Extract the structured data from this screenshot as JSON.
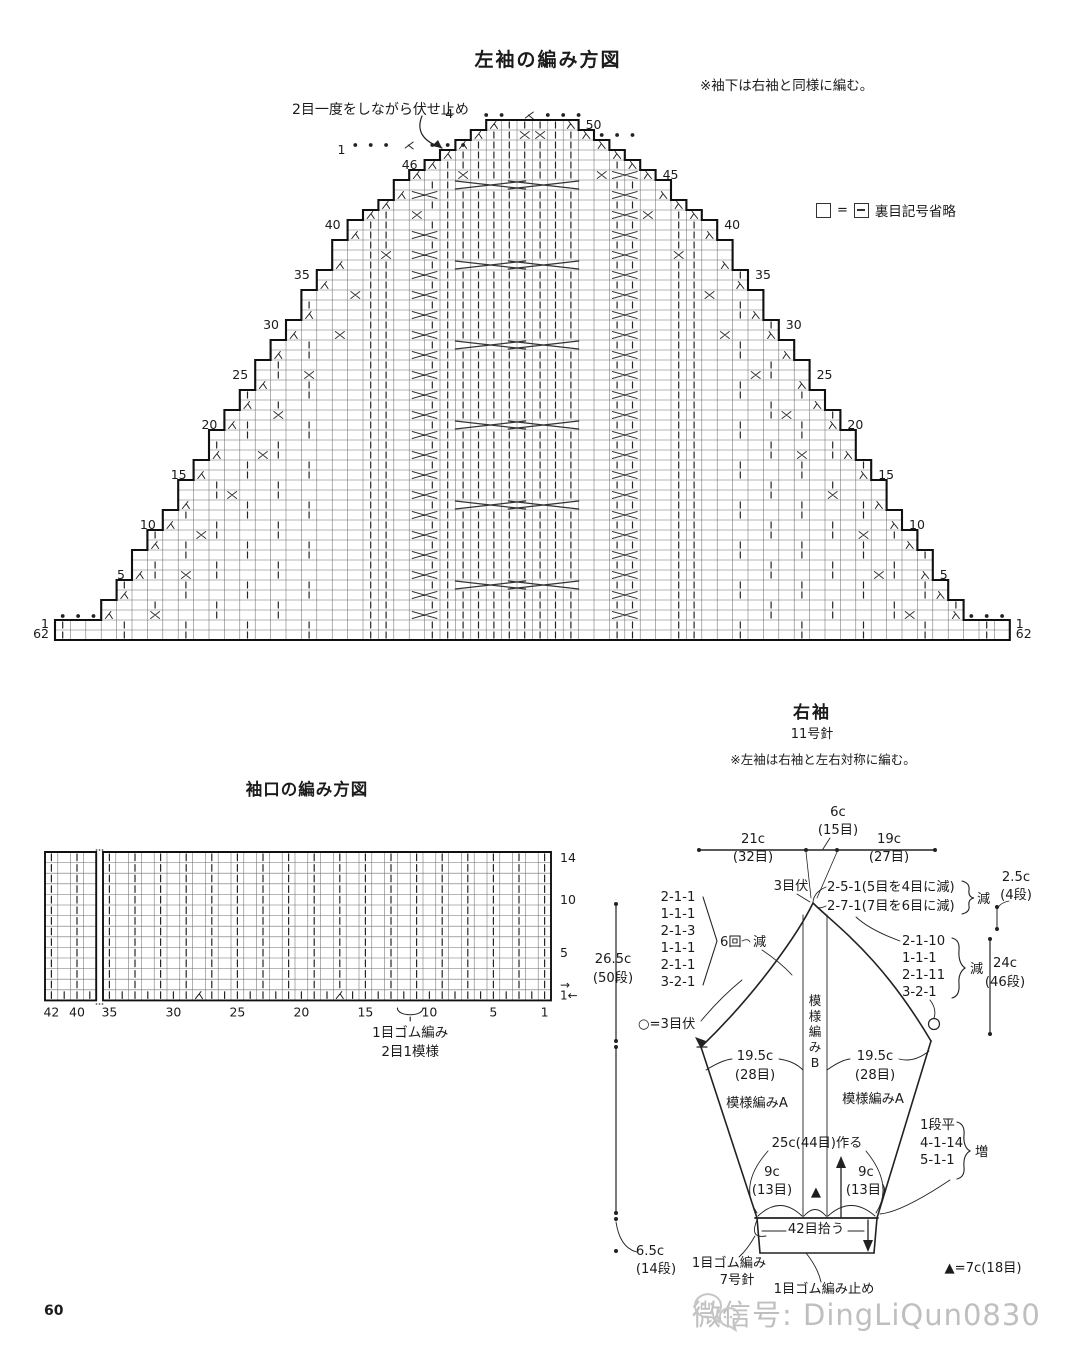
{
  "page": {
    "number": "60",
    "watermark_text": "微信号: DingLiQun0830"
  },
  "main_chart": {
    "title": "左袖の編み方図",
    "note": "※袖下は右袖と同様に編む。",
    "bind_off_annotation": "2目一度をしながら伏せ止め",
    "legend_equals": "=",
    "legend_text": "裏目記号省略",
    "top_stitch_labels": {
      "four": "4",
      "left_one": "1"
    },
    "left_row_labels": [
      46,
      40,
      35,
      30,
      25,
      20,
      15,
      10,
      5
    ],
    "right_row_labels": [
      50,
      45,
      40,
      35,
      30,
      25,
      20,
      15,
      10,
      5
    ],
    "bottom_row_labels": [
      "1",
      "62"
    ],
    "cols": 62,
    "cap_rows": 50,
    "base_rows": 2
  },
  "cuff_chart": {
    "title": "袖口の編み方図",
    "bottom_labels": [
      "42",
      "40",
      "35",
      "30",
      "25",
      "20",
      "15",
      "10",
      "5",
      "1"
    ],
    "right_labels": [
      "14",
      "10",
      "5"
    ],
    "direction_arrows": [
      "→",
      "1←"
    ],
    "repeat_brace_labels": [
      "1目ゴム編み",
      "2目1模様"
    ],
    "rows": 14
  },
  "schematic": {
    "title": "右袖",
    "needle": "11号針",
    "note": "※左袖は右袖と左右対称に編む。",
    "labels": [
      {
        "id": "width-21c",
        "t": "21c",
        "x": 753,
        "y": 843
      },
      {
        "id": "width-21c-sts",
        "t": "(32目)",
        "x": 753,
        "y": 861
      },
      {
        "id": "width-6c",
        "t": "6c",
        "x": 838,
        "y": 816
      },
      {
        "id": "width-6c-sts",
        "t": "(15目)",
        "x": 838,
        "y": 834
      },
      {
        "id": "width-19c",
        "t": "19c",
        "x": 889,
        "y": 843
      },
      {
        "id": "width-19c-sts",
        "t": "(27目)",
        "x": 889,
        "y": 861
      },
      {
        "id": "bind-off-3",
        "t": "3目伏",
        "x": 791,
        "y": 890
      },
      {
        "id": "dec-right-a1",
        "t": "2-5-1(5目を4目に減)",
        "x": 827,
        "y": 891,
        "a": "start"
      },
      {
        "id": "dec-right-a2",
        "t": "2-7-1(7目を6目に減)",
        "x": 827,
        "y": 910,
        "a": "start"
      },
      {
        "id": "dec-right-a-label",
        "t": "減",
        "x": 977,
        "y": 903,
        "a": "start"
      },
      {
        "id": "height-2-5c",
        "t": "2.5c",
        "x": 1016,
        "y": 881
      },
      {
        "id": "height-2-5c-rows",
        "t": "(4段)",
        "x": 1016,
        "y": 899
      },
      {
        "id": "dec-left-1",
        "t": "2-1-1",
        "x": 678,
        "y": 901
      },
      {
        "id": "dec-left-2",
        "t": "1-1-1",
        "x": 678,
        "y": 918
      },
      {
        "id": "dec-left-3",
        "t": "2-1-3",
        "x": 678,
        "y": 935
      },
      {
        "id": "dec-left-4",
        "t": "1-1-1",
        "x": 678,
        "y": 952
      },
      {
        "id": "dec-left-5",
        "t": "2-1-1",
        "x": 678,
        "y": 969
      },
      {
        "id": "dec-left-6",
        "t": "3-2-1",
        "x": 678,
        "y": 986
      },
      {
        "id": "dec-left-times",
        "t": "6回",
        "x": 720,
        "y": 946,
        "a": "start"
      },
      {
        "id": "dec-left-label",
        "t": "減",
        "x": 753,
        "y": 946,
        "a": "start"
      },
      {
        "id": "height-26-5c",
        "t": "26.5c",
        "x": 613,
        "y": 963
      },
      {
        "id": "height-26-5c-rows",
        "t": "(50段)",
        "x": 613,
        "y": 982
      },
      {
        "id": "dec-right-b1",
        "t": "2-1-10",
        "x": 902,
        "y": 945,
        "a": "start"
      },
      {
        "id": "dec-right-b2",
        "t": "1-1-1",
        "x": 902,
        "y": 962,
        "a": "start"
      },
      {
        "id": "dec-right-b3",
        "t": "2-1-11",
        "x": 902,
        "y": 979,
        "a": "start"
      },
      {
        "id": "dec-right-b4",
        "t": "3-2-1",
        "x": 902,
        "y": 996,
        "a": "start"
      },
      {
        "id": "dec-right-b-label",
        "t": "減",
        "x": 970,
        "y": 973,
        "a": "start"
      },
      {
        "id": "height-24c",
        "t": "24c",
        "x": 1005,
        "y": 967
      },
      {
        "id": "height-24c-rows",
        "t": "(46段)",
        "x": 1005,
        "y": 986
      },
      {
        "id": "circle-legend",
        "t": "○=3目伏",
        "x": 638,
        "y": 1028,
        "a": "start"
      },
      {
        "id": "width-19-5c-left",
        "t": "19.5c",
        "x": 755,
        "y": 1060
      },
      {
        "id": "width-19-5c-left-sts",
        "t": "(28目)",
        "x": 755,
        "y": 1079
      },
      {
        "id": "width-19-5c-right",
        "t": "19.5c",
        "x": 875,
        "y": 1060
      },
      {
        "id": "width-19-5c-right-sts",
        "t": "(28目)",
        "x": 875,
        "y": 1079
      },
      {
        "id": "panel-b",
        "t": "模様編みB",
        "x": 815,
        "y": 1005,
        "v": true
      },
      {
        "id": "panel-a-left",
        "t": "模様編みA",
        "x": 757,
        "y": 1107
      },
      {
        "id": "panel-a-right",
        "t": "模様編みA",
        "x": 873,
        "y": 1103
      },
      {
        "id": "cast-on",
        "t": "25c(44目)作る",
        "x": 817,
        "y": 1147
      },
      {
        "id": "inc-flat",
        "t": "1段平",
        "x": 920,
        "y": 1129,
        "a": "start"
      },
      {
        "id": "inc-seq1",
        "t": "4-1-14",
        "x": 920,
        "y": 1147,
        "a": "start"
      },
      {
        "id": "inc-seq2",
        "t": "5-1-1",
        "x": 920,
        "y": 1164,
        "a": "start"
      },
      {
        "id": "inc-label",
        "t": "増",
        "x": 975,
        "y": 1156,
        "a": "start"
      },
      {
        "id": "width-9c-left",
        "t": "9c",
        "x": 772,
        "y": 1176
      },
      {
        "id": "width-9c-left-sts",
        "t": "(13目)",
        "x": 772,
        "y": 1194
      },
      {
        "id": "width-9c-right",
        "t": "9c",
        "x": 866,
        "y": 1176
      },
      {
        "id": "width-9c-right-sts",
        "t": "(13目)",
        "x": 866,
        "y": 1194
      },
      {
        "id": "pickup-42",
        "t": "42目拾う",
        "x": 816,
        "y": 1233
      },
      {
        "id": "height-6-5c",
        "t": "6.5c",
        "x": 650,
        "y": 1255
      },
      {
        "id": "height-6-5c-rows",
        "t": "(14段)",
        "x": 656,
        "y": 1273
      },
      {
        "id": "cuff-rib",
        "t": "1目ゴム編み",
        "x": 729,
        "y": 1267
      },
      {
        "id": "cuff-needle",
        "t": "7号針",
        "x": 737,
        "y": 1284
      },
      {
        "id": "rib-bind-off",
        "t": "1目ゴム編み止め",
        "x": 824,
        "y": 1293
      },
      {
        "id": "triangle-legend",
        "t": "▲=7c(18目)",
        "x": 983,
        "y": 1272
      },
      {
        "id": "triangle-marker",
        "t": "▲",
        "x": 816,
        "y": 1196
      }
    ]
  }
}
